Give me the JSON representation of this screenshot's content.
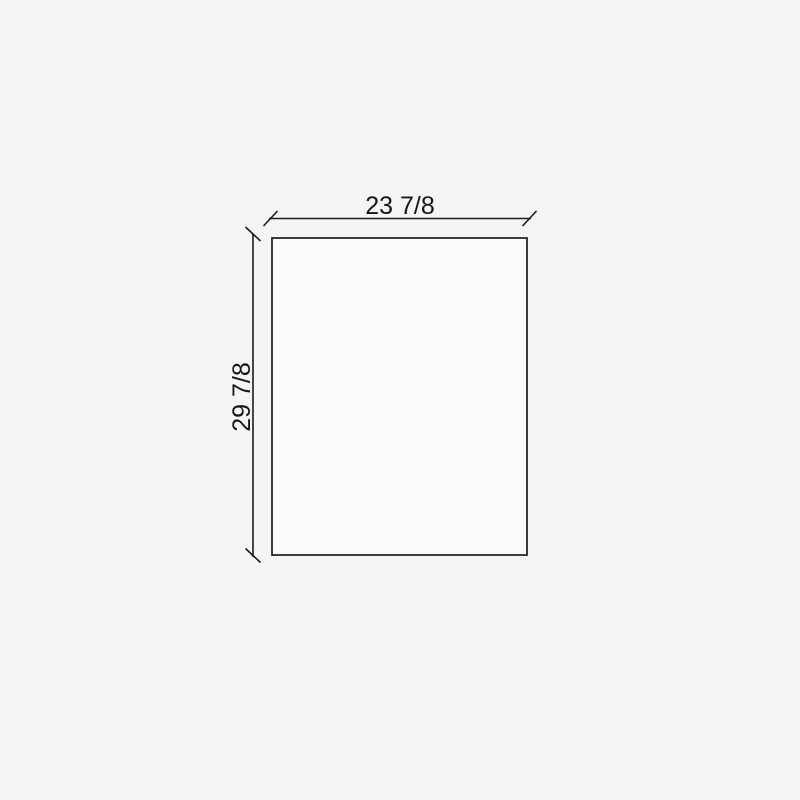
{
  "drawing": {
    "dimensions": {
      "width_label": "23 7/8",
      "height_label": "29 7/8"
    },
    "colors": {
      "background": "#f5f5f5",
      "panel_fill": "#fbfbfb",
      "line": "#1c1c1c",
      "text": "#161616"
    }
  }
}
